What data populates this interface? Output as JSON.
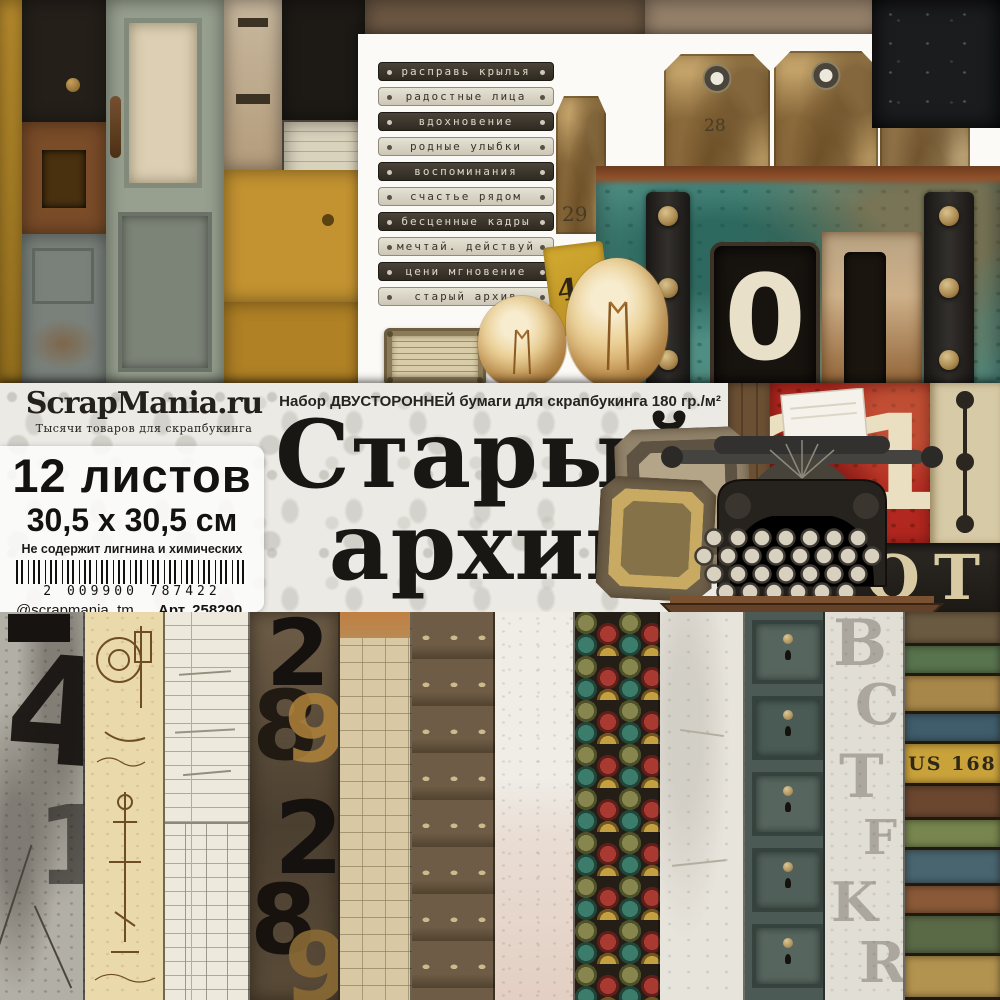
{
  "banner": {
    "brand": {
      "logo": "ScrapMania.ru",
      "tagline": "Тысячи товаров для скрапбукинга"
    },
    "subtitle": "Набор ДВУСТОРОННЕЙ бумаги для скрапбукинга 180 гр./м²",
    "title_line1": "Старый",
    "title_line2": "архив",
    "sheets_count": "12 листов",
    "sheet_size": "30,5 x 30,5 см",
    "acid_free_note": "Не содержит лигнина и химических кислот",
    "barcode": "2 009900 787422",
    "instagram": "@scrapmania_tm",
    "article": "Арт. 258290"
  },
  "word_strips": [
    {
      "text": "расправь крылья"
    },
    {
      "text": "радостные лица"
    },
    {
      "text": "вдохновение"
    },
    {
      "text": "родные улыбки"
    },
    {
      "text": "воспоминания"
    },
    {
      "text": "счастье рядом"
    },
    {
      "text": "бесценные кадры"
    },
    {
      "text": "мечтай. действуй"
    },
    {
      "text": "цени мгновение"
    },
    {
      "text": "старый архив"
    }
  ],
  "photo_labels": {
    "tag_left_number": "29",
    "tag_number": "28",
    "yellow_tag_number": "46",
    "trunk_stencil": "0",
    "red_sign_number": "21",
    "dark_sign_letters": "ОТ",
    "plank_sign": "US 168",
    "strip1_number_large": "4",
    "strip1_number_small": "1",
    "strip4_digits": [
      "2",
      "8",
      "9",
      "2",
      "8",
      "9"
    ],
    "strip11_letters": [
      "B",
      "C",
      "T",
      "F",
      "K",
      "R"
    ]
  },
  "colors": {
    "accent_red": "#b2271f",
    "trunk_teal": "#4f8e83",
    "mustard": "#c79833",
    "banner_bg": "#eceae5",
    "text_dark": "#191714"
  }
}
